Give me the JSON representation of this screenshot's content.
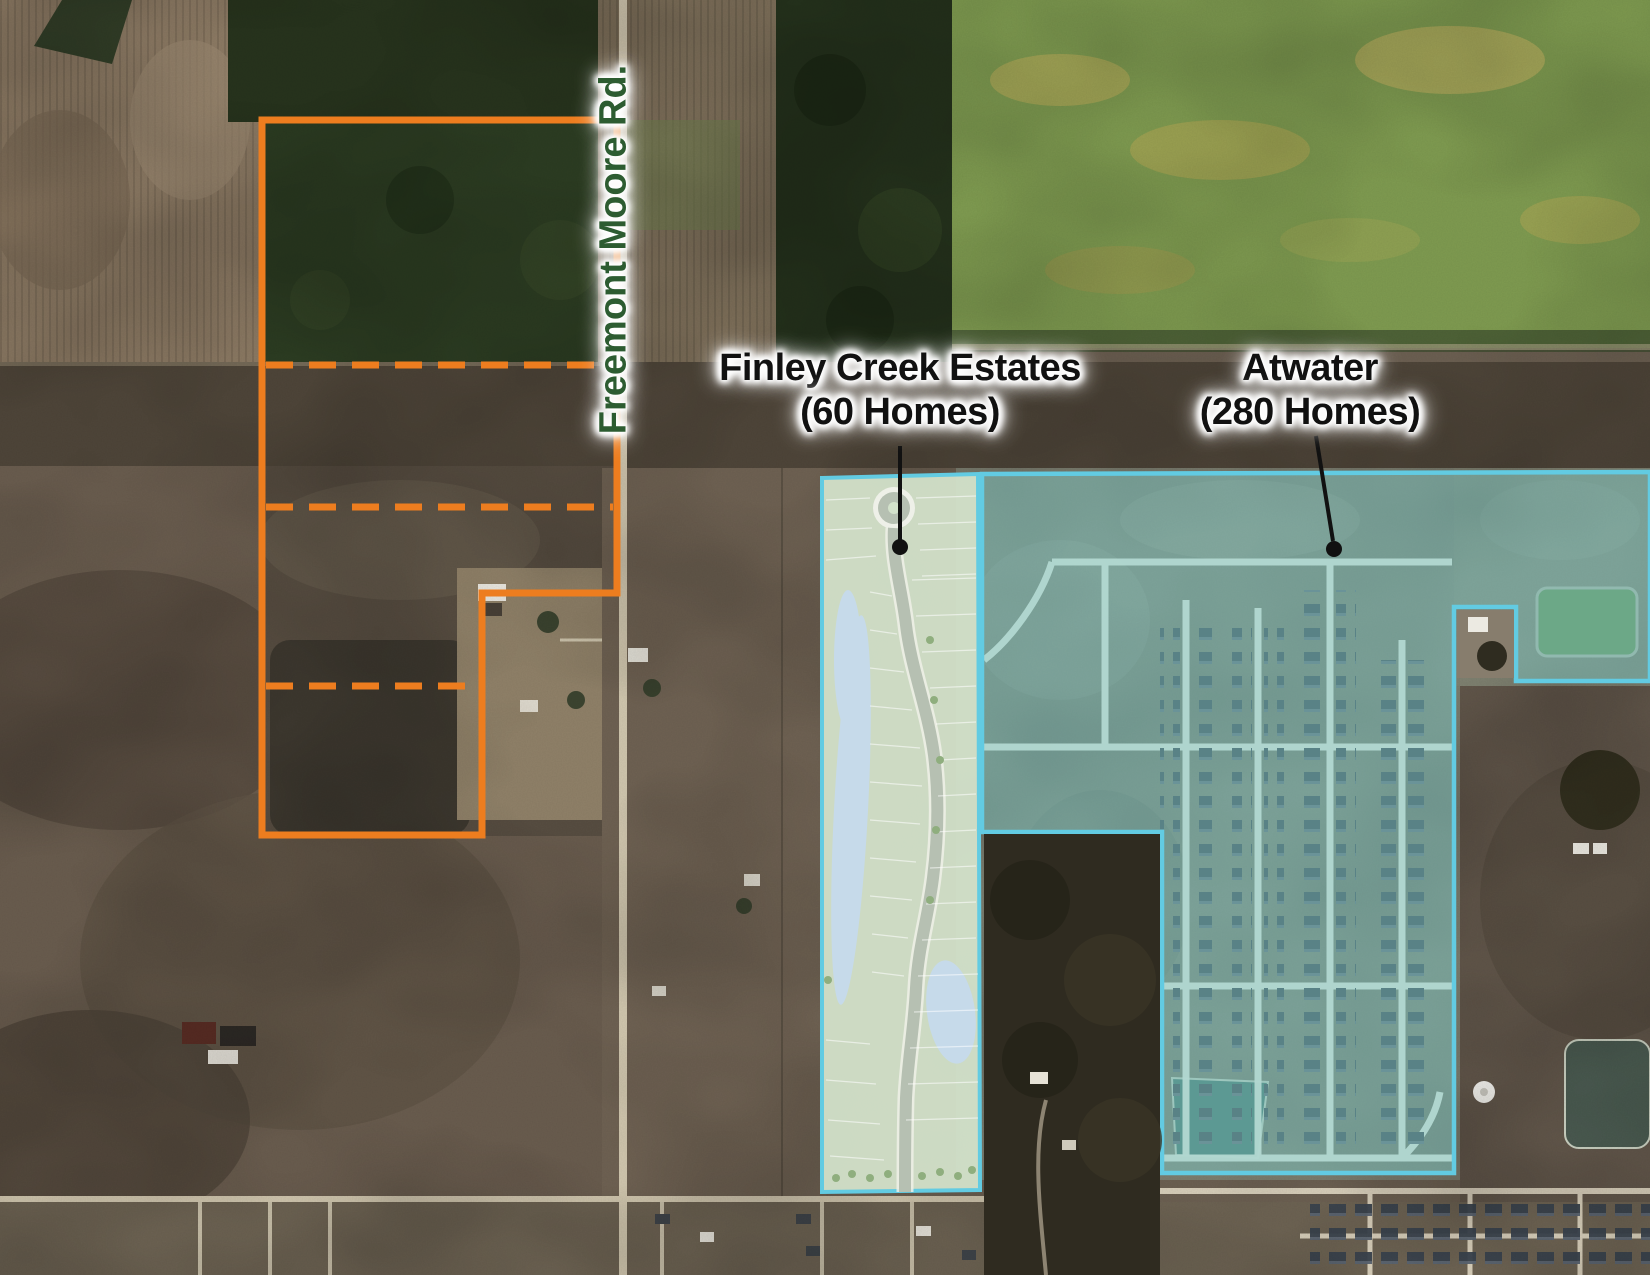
{
  "road_label": "Freemont Moore Rd.",
  "annotations": {
    "finley": {
      "line1": "Finley Creek Estates",
      "line2": "(60 Homes)",
      "homes": 60
    },
    "atwater": {
      "line1": "Atwater",
      "line2": "(280 Homes)",
      "homes": 280
    }
  },
  "colors": {
    "parcel_outline": "#ED7D1F",
    "development_border": "#62CBE2",
    "development_fill": "rgba(125,200,196,0.48)",
    "road_label_text": "#2D5C31",
    "annotation_text": "#111111",
    "leader_line": "#111111"
  }
}
